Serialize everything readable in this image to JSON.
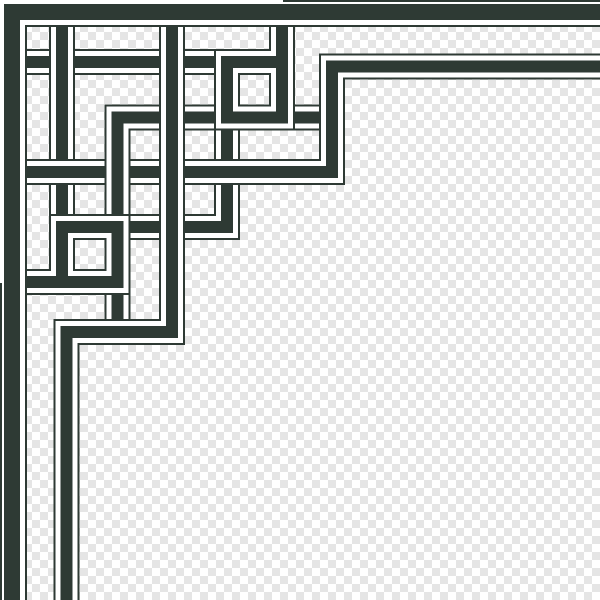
{
  "artwork": {
    "title": "corner-knot-border-ornament",
    "canvas": {
      "width": 600,
      "height": 600
    },
    "background": {
      "checker_light": "#ffffff",
      "checker_dark": "#e5e5e5",
      "checker_size": 8
    },
    "palette": {
      "strand": "#2e3a34",
      "outline": "#2e3a34",
      "gap": "#ffffff"
    },
    "ribbon_style": {
      "gap_margin": 5,
      "outline_thickness": 2
    },
    "strands": [
      {
        "name": "center-step-strand",
        "type": "ribbon",
        "width": 12,
        "points": [
          [
            332,
            117.5
          ],
          [
            117.5,
            117.5
          ],
          [
            117.5,
            332
          ]
        ]
      },
      {
        "name": "center-corner-connector",
        "type": "ribbon",
        "width": 12,
        "points": [
          [
            227,
            112
          ],
          [
            227,
            227
          ],
          [
            112,
            227
          ]
        ]
      },
      {
        "name": "top-cross-bar",
        "type": "ribbon",
        "width": 12,
        "points": [
          [
            18,
            62
          ],
          [
            227,
            62
          ]
        ]
      },
      {
        "name": "left-cross-bar",
        "type": "ribbon",
        "width": 12,
        "points": [
          [
            62,
            18
          ],
          [
            62,
            227
          ]
        ]
      },
      {
        "name": "top-right-loop-spiral",
        "type": "ribbon",
        "width": 12,
        "points": [
          [
            282,
            8
          ],
          [
            282,
            117.5
          ],
          [
            227,
            117.5
          ],
          [
            227,
            62
          ],
          [
            282,
            62
          ]
        ]
      },
      {
        "name": "bottom-left-loop-spiral",
        "type": "ribbon",
        "width": 12,
        "points": [
          [
            8,
            282
          ],
          [
            117.5,
            282
          ],
          [
            117.5,
            227
          ],
          [
            62,
            227
          ],
          [
            62,
            282
          ]
        ]
      },
      {
        "name": "inner-border-top-ribbon",
        "type": "ribbon",
        "width": 12,
        "points": [
          [
            13,
            172
          ],
          [
            332,
            172
          ],
          [
            332,
            66.5
          ],
          [
            600,
            66.5
          ]
        ]
      },
      {
        "name": "inner-border-left-ribbon",
        "type": "ribbon",
        "width": 12,
        "points": [
          [
            172,
            13
          ],
          [
            172,
            332
          ],
          [
            66.5,
            332
          ],
          [
            66.5,
            600
          ]
        ]
      },
      {
        "name": "outer-border-ribbon",
        "type": "ribbon",
        "width": 16,
        "points": [
          [
            600,
            12
          ],
          [
            12,
            12
          ],
          [
            12,
            600
          ]
        ]
      },
      {
        "name": "outer-edge-line-top",
        "type": "line",
        "width": 2,
        "points": [
          [
            283,
            1
          ],
          [
            600,
            1
          ]
        ]
      },
      {
        "name": "outer-edge-line-left",
        "type": "line",
        "width": 2,
        "points": [
          [
            1,
            283
          ],
          [
            1,
            600
          ]
        ]
      },
      {
        "name": "center-step-weave-patch",
        "type": "ribbon",
        "width": 12,
        "points": [
          [
            117.5,
            150
          ],
          [
            117.5,
            195
          ]
        ]
      }
    ]
  }
}
